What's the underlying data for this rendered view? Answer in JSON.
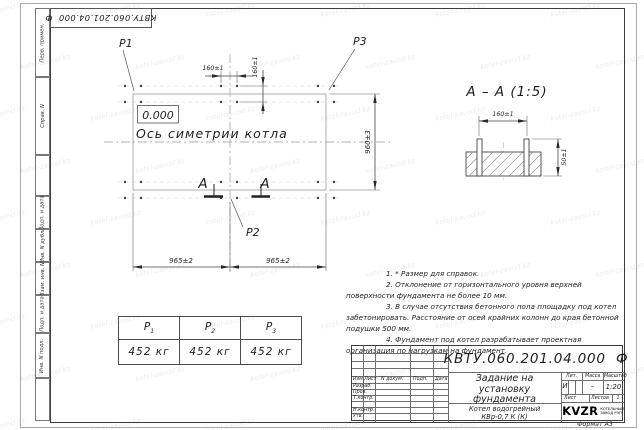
{
  "watermark": "kotel-zavod.kz",
  "frame": {
    "top_stamp": "КВТУ.060.201.04.000  Ф",
    "left_labels": {
      "perv": "Перв. примен.",
      "sprav": "Справ. N",
      "podp1": "Подп. и дата",
      "inv_dubl": "Инв. N дубл.",
      "vzam": "Взам. инв. N",
      "podp2": "Подп. и дата",
      "inv_podl": "Инв. N подл."
    },
    "format_label": "Формат А3"
  },
  "plan": {
    "p1_label": "Р1",
    "p2_label": "Р2",
    "p3_label": "Р3",
    "level_mark": "0.000",
    "axis_label": "Ось симетрии котла",
    "dim_bolt_horizontal": "160±1",
    "dim_bolt_vertical": "160±1",
    "dim_width_left": "965±2",
    "dim_width_right": "965±2",
    "dim_depth": "960±3",
    "section_letter_left": "А",
    "section_letter_right": "А"
  },
  "section_view": {
    "title": "А – А (1:5)",
    "dim_bolts": "160±1",
    "dim_protrusion": "50±1"
  },
  "loads_table": {
    "columns": [
      {
        "symbol": "Р",
        "sub": "1",
        "value": "452 кг"
      },
      {
        "symbol": "Р",
        "sub": "2",
        "value": "452 кг"
      },
      {
        "symbol": "Р",
        "sub": "3",
        "value": "452 кг"
      }
    ]
  },
  "notes": [
    "1. * Размер для справок.",
    "2. Отклонение от горизонтального уровня верхней поверхности фундамента не более 10 мм.",
    "3. В случае отсутствия бетонного пола площадку под котел забетонировать. Расстояние от осей крайних колонн до края бетонной подушки 500 мм.",
    "4. Фундамент под котел разрабатывает проектная организация по нагрузкам на фундамент."
  ],
  "title_block": {
    "doc_number": "КВТУ.060.201.04.000  Ф",
    "title_lines": [
      "Задание на",
      "установку",
      "фундамента"
    ],
    "product_lines": [
      "Котел водогрейный",
      "КВр-0,7 К (К)"
    ],
    "rev_headers": [
      "Изм.Лист",
      "N докум.",
      "Подп.",
      "Дата"
    ],
    "roles": [
      "Разраб.",
      "Пров.",
      "Т.контр.",
      "Н.контр.",
      "Утв."
    ],
    "lit_label": "Лит.",
    "lit_value": "И",
    "mass_label": "Масса",
    "mass_value": "–",
    "scale_label": "Масштаб",
    "scale_value": "1:20",
    "sheet_label": "Лист",
    "sheets_label": "Листов",
    "sheets_value": "1",
    "company_name": "KVZR",
    "company_sub1": "КОТЕЛЬНЫЙ",
    "company_sub2": "ЗАВОД РЭП"
  }
}
